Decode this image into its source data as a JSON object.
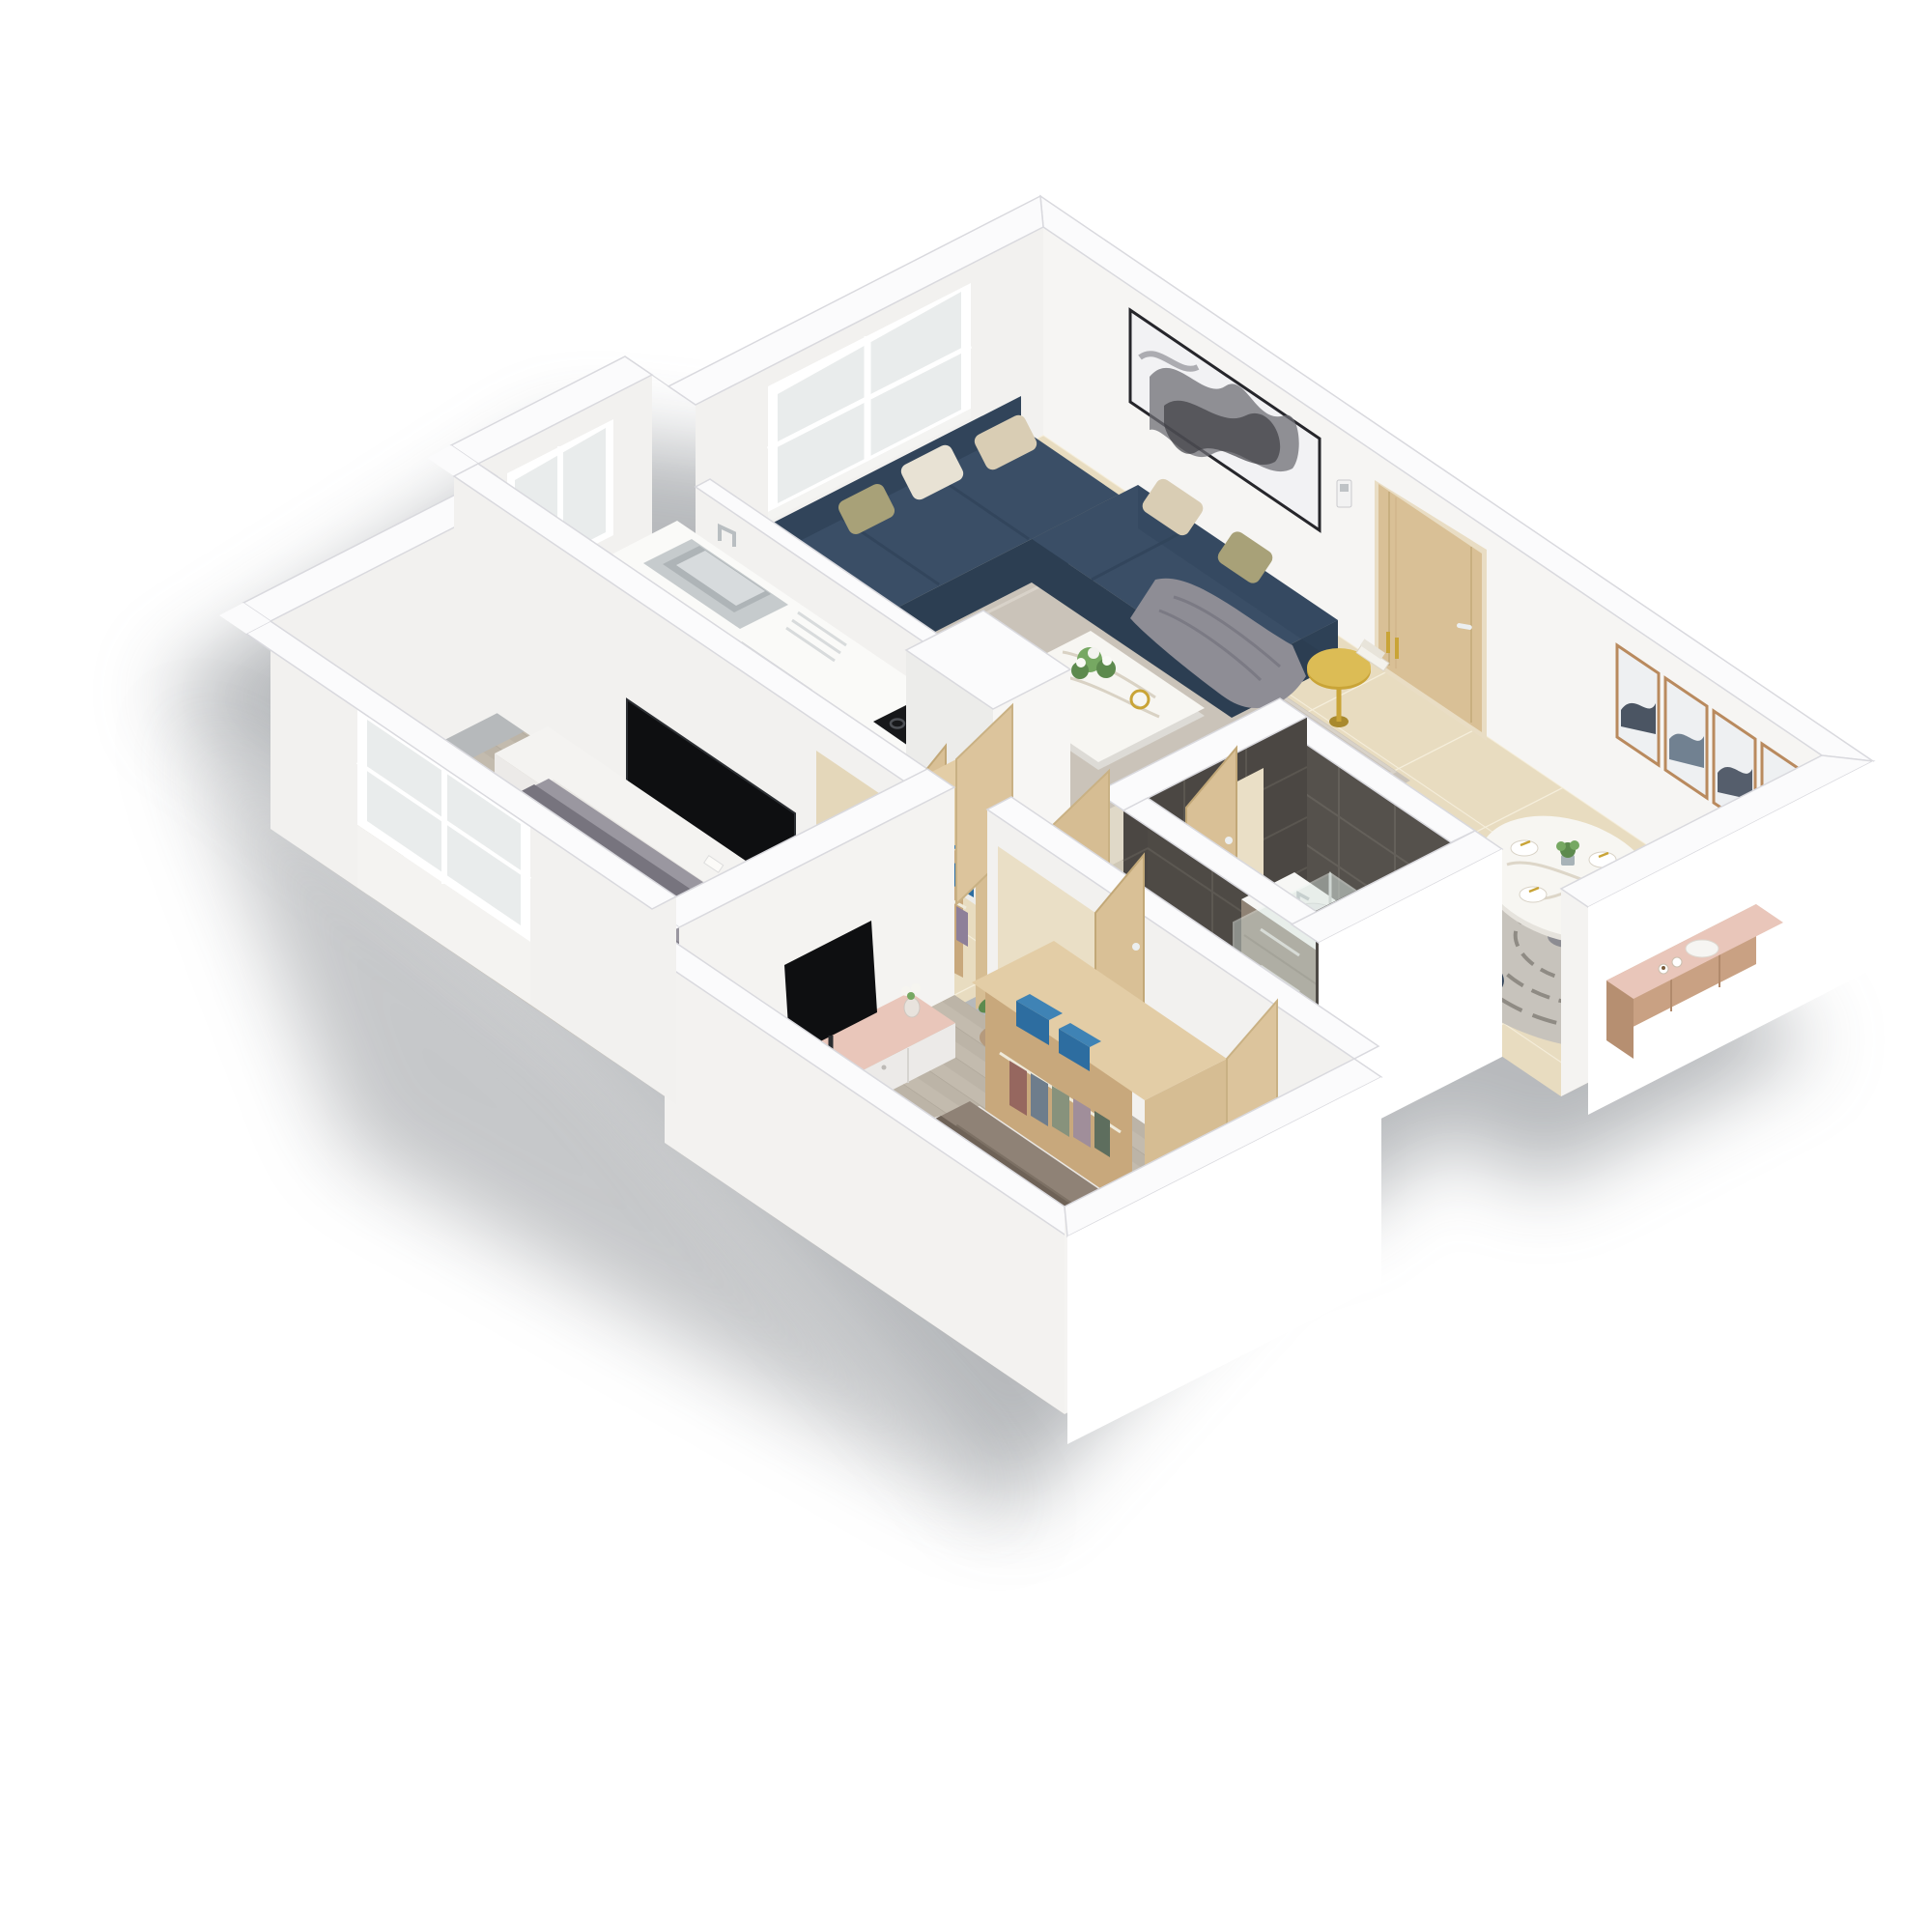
{
  "scene": {
    "type": "isometric-3d-floor-plan-render",
    "background": "#ffffff",
    "shadow": "#6f747a"
  },
  "palette": {
    "wallTop": "#fbfbfc",
    "wallLight": "#f6f5f3",
    "wallShade": "#ececea",
    "wallBright": "#ffffff",
    "floorBeige": "#e8dcc0",
    "groutBeige": "#f5eedb",
    "tileDark": "#34373c",
    "groutDark": "#51565e",
    "woodFloor": "#c3bbae",
    "woodFloorLine": "#b0a89b",
    "bathFloor": "#7d7872",
    "bathWall": "#55514c",
    "bathWallDark": "#4b4743",
    "sofaNavy": "#31445a",
    "sofaTop": "#3a4e66",
    "sofaDark": "#2c3e52",
    "rugLiving": "#cac3b9",
    "rugDining": "#c7c3bc",
    "marble": "#f7f6f2",
    "gold": "#c9a437",
    "doorWood": "#d9c096",
    "doorEdge": "#c2a878",
    "consolePink": "#e9c6ba",
    "consoleWhite": "#eceae8",
    "towelBlue": "#2d6da0",
    "duvetGray": "#9a97a0",
    "duvetTaupe": "#8f8276",
    "runnerDark": "#6e6257",
    "chairNavy": "#2f4055",
    "glassTint": "#d7e4de",
    "steel": "#cfd2d4",
    "tvBlack": "#0e0f11",
    "artFrame": "#b98a5e",
    "plantGreen": "#5d8a4e",
    "pillowBeige": "#d9cdb4",
    "pillowOlive": "#a8a178",
    "throwGray": "#8e8d95",
    "armchairBeige": "#d8d1c0",
    "counterWood": "#9b8063",
    "vanityWood": "#8f8274",
    "closetWood": "#d6bd93",
    "closetWoodLight": "#e3cda6",
    "closetInner": "#c8a87c",
    "purplePillow": "#9b8da5"
  },
  "rooms": {
    "living_room": {
      "items": [
        "sectional-sofa",
        "cushions",
        "throw-blanket",
        "area-rug",
        "marble-coffee-table",
        "flower-vase",
        "gold-side-table",
        "armchair",
        "large-abstract-wall-art",
        "window"
      ]
    },
    "dining_area": {
      "items": [
        "round-marble-table",
        "dining-chairs",
        "round-patterned-rug",
        "four-panel-wall-art",
        "sideboard",
        "floor-lamp",
        "entry-door",
        "intercom"
      ]
    },
    "kitchen": {
      "items": [
        "sink-counter",
        "faucet",
        "washing-machine",
        "dishwasher",
        "gas-cooktop",
        "oven",
        "dark-tile-floor",
        "window"
      ]
    },
    "bathroom": {
      "items": [
        "vanity-with-basin",
        "toilet",
        "walk-in-shower",
        "glass-partition",
        "dark-wall-tiles",
        "toilet-paper"
      ]
    },
    "bedroom_1": {
      "items": [
        "double-bed-gray",
        "patterned-pillows",
        "tv-media-console",
        "wall-tv",
        "bedside-table",
        "window"
      ]
    },
    "bedroom_2": {
      "items": [
        "double-bed-taupe",
        "pink-top-tv-console",
        "tv",
        "open-wardrobe",
        "blue-folded-towels",
        "hanging-clothes",
        "potted-plant",
        "drum-stools"
      ]
    },
    "hall": {
      "items": [
        "storage-closet",
        "blue-towels",
        "open-wood-doors",
        "white-column"
      ]
    }
  }
}
